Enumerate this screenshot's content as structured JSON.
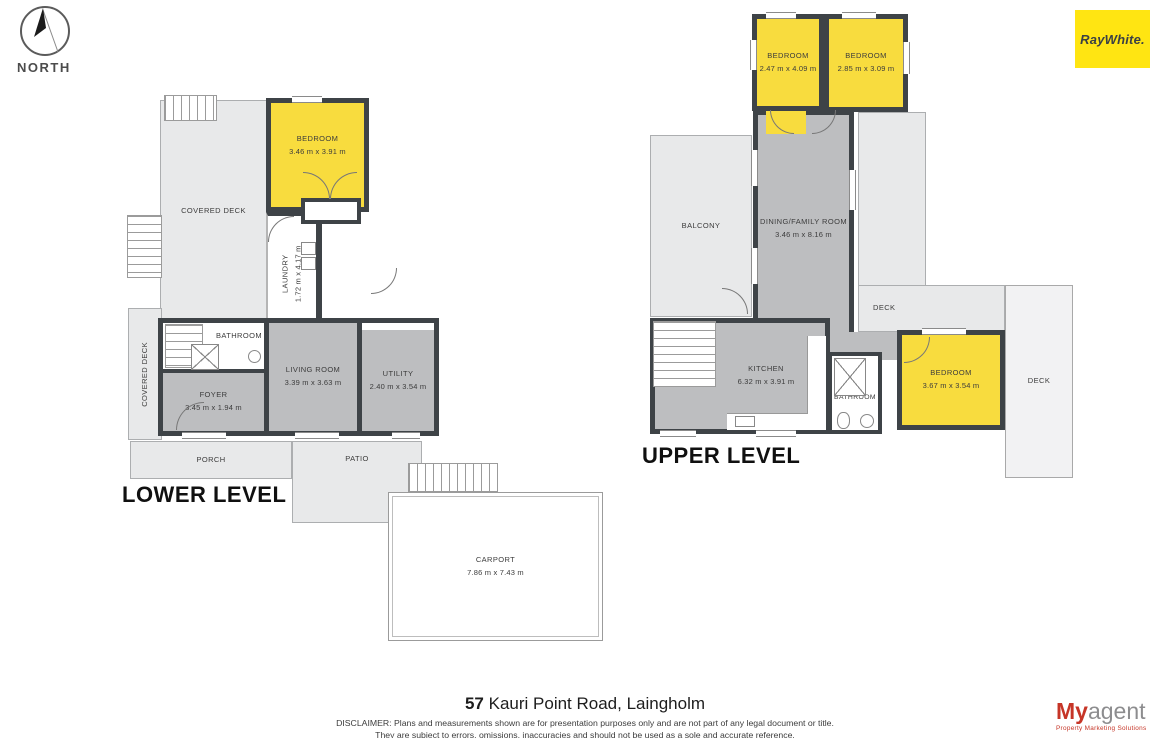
{
  "compass": {
    "label": "NORTH"
  },
  "brand": {
    "name": "RayWhite."
  },
  "colors": {
    "room_yellow": "#F8DC3E",
    "brand_yellow": "#FFE512",
    "wall": "#3E4347",
    "room_gray": "#BDBEC0",
    "outdoor_gray": "#E8E9EA",
    "agency_red": "#C63527"
  },
  "lower_level": {
    "title": "LOWER LEVEL",
    "covered_deck": {
      "name": "COVERED DECK"
    },
    "covered_deck_side": {
      "name": "COVERED DECK"
    },
    "bedroom": {
      "name": "BEDROOM",
      "dims": "3.46 m x 3.91 m"
    },
    "laundry": {
      "name": "LAUNDRY",
      "dims": "1.72 m x 4.17 m"
    },
    "bathroom": {
      "name": "BATHROOM"
    },
    "foyer": {
      "name": "FOYER",
      "dims": "3.45 m x 1.94 m"
    },
    "living_room": {
      "name": "LIVING ROOM",
      "dims": "3.39 m x 3.63 m"
    },
    "utility": {
      "name": "UTILITY",
      "dims": "2.40 m x 3.54 m"
    },
    "porch": {
      "name": "PORCH"
    },
    "patio": {
      "name": "PATIO"
    },
    "carport": {
      "name": "CARPORT",
      "dims": "7.86 m x 7.43 m"
    }
  },
  "upper_level": {
    "title": "UPPER LEVEL",
    "bedroom_1": {
      "name": "BEDROOM",
      "dims": "2.47 m x 4.09 m"
    },
    "bedroom_2": {
      "name": "BEDROOM",
      "dims": "2.85 m x 3.09 m"
    },
    "bedroom_3": {
      "name": "BEDROOM",
      "dims": "3.67 m x 3.54 m"
    },
    "balcony": {
      "name": "BALCONY"
    },
    "dining_family": {
      "name": "DINING/FAMILY ROOM",
      "dims": "3.46 m x 8.16 m"
    },
    "kitchen": {
      "name": "KITCHEN",
      "dims": "6.32 m x 3.91 m"
    },
    "bathroom": {
      "name": "BATHROOM"
    },
    "deck_upper": {
      "name": "DECK"
    },
    "deck_side": {
      "name": "DECK"
    }
  },
  "footer": {
    "address_number": "57",
    "address_street": " Kauri Point Road, Laingholm",
    "disclaimer_line_1": "DISCLAIMER: Plans and measurements shown are for presentation purposes only and are not part of any legal document or title.",
    "disclaimer_line_2": "They are subject to errors, omissions, inaccuracies and should not be used as a sole and accurate reference.",
    "agency_name_bold": "My",
    "agency_name_light": "agent",
    "agency_tagline": "Property Marketing Solutions"
  }
}
